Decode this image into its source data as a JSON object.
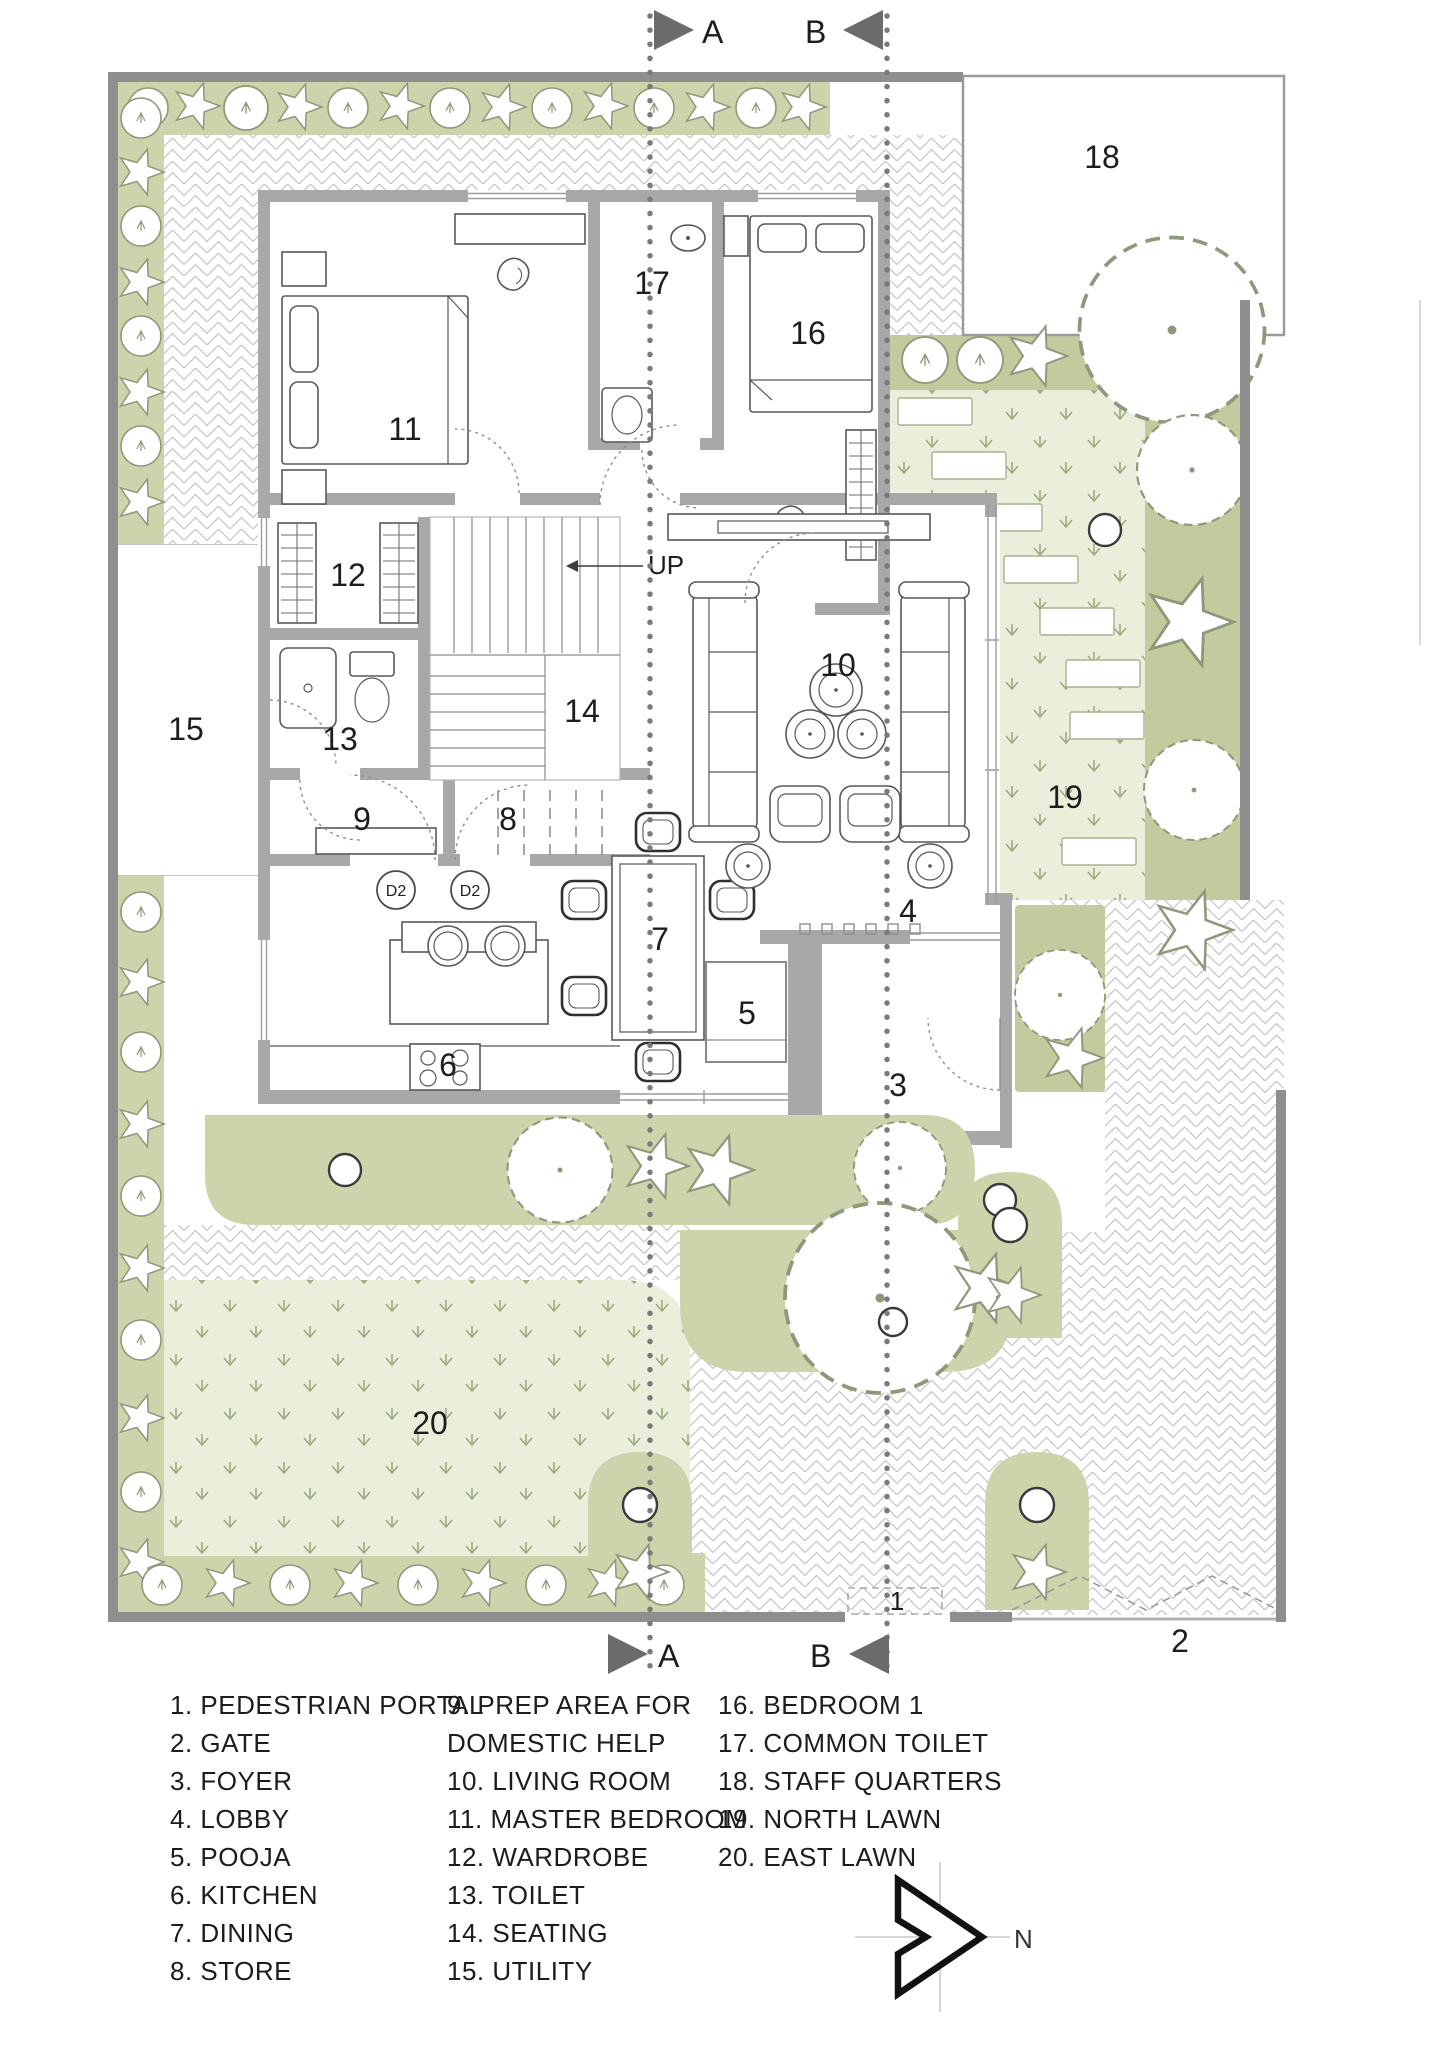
{
  "plan": {
    "rooms": [
      "1",
      "2",
      "3",
      "4",
      "5",
      "6",
      "7",
      "8",
      "9",
      "10",
      "11",
      "12",
      "13",
      "14",
      "15",
      "16",
      "17",
      "18",
      "19",
      "20"
    ],
    "sections": {
      "a": "A",
      "b": "B"
    },
    "up": "UP",
    "door_tag": "D2",
    "north": "N"
  },
  "legend": {
    "col1": [
      "1. PEDESTRIAN PORTAL",
      "2. GATE",
      "3. FOYER",
      "4. LOBBY",
      "5. POOJA",
      "6. KITCHEN",
      "7. DINING",
      "8. STORE"
    ],
    "col2": [
      "9. PREP AREA FOR",
      "DOMESTIC HELP",
      "10. LIVING ROOM",
      "11. MASTER BEDROOM",
      "12. WARDROBE",
      "13. TOILET",
      "14. SEATING",
      "15. UTILITY"
    ],
    "col3": [
      "16. BEDROOM 1",
      "17. COMMON TOILET",
      "18. STAFF QUARTERS",
      "19. NORTH LAWN",
      "20. EAST LAWN"
    ]
  },
  "colors": {
    "planting": "#cdd4ab",
    "planting_dark": "#c3cb9e",
    "lawn": "#e9efda",
    "grass_mark": "#9dab80",
    "wall": "#a8a8a8",
    "boundary": "#8e8e8e",
    "paving_line": "#c8c8c8",
    "section_marker": "#6b6b6b"
  }
}
